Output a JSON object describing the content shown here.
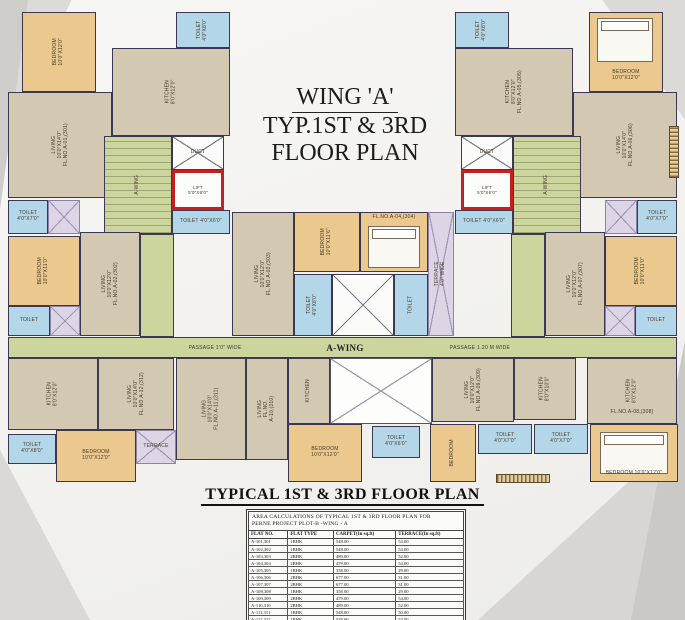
{
  "title": {
    "line1": "WING 'A'",
    "line2": "TYP.1ST & 3RD",
    "line3": "FLOOR PLAN"
  },
  "footer": {
    "heading": "TYPICAL 1ST & 3RD FLOOR PLAN"
  },
  "plan": {
    "passage_left": "PASSAGE 1'0\" WIDE",
    "wing_label": "A-WING",
    "passage_right": "PASSAGE 1.20 M WIDE",
    "colors": {
      "bedroom": "#ebc98e",
      "living_kitchen": "#d3c9b3",
      "toilet": "#b3d7e8",
      "terrace": "#ddd5e6",
      "stair_passage": "#ccd59d",
      "lift_outline": "#c4201e",
      "wall": "#3d3852"
    },
    "rooms": [
      {
        "t": "bed",
        "x": 22,
        "y": 12,
        "w": 74,
        "h": 80,
        "l": "BEDROOM\n10'0\"X12'0\"",
        "rot": true
      },
      {
        "t": "toi",
        "x": 176,
        "y": 12,
        "w": 54,
        "h": 36,
        "l": "TOILET\n4'0\"X8'0\"",
        "rot": true
      },
      {
        "t": "kit",
        "x": 112,
        "y": 48,
        "w": 118,
        "h": 88,
        "l": "KITCHEN\n8'0\"X12'0\"",
        "rot": true
      },
      {
        "t": "liv",
        "x": 8,
        "y": 92,
        "w": 104,
        "h": 106,
        "l": "LIVING\n10'0\"X14'0\"\nFL.NO.A-01,(301)",
        "rot": true
      },
      {
        "t": "stair",
        "x": 104,
        "y": 136,
        "w": 68,
        "h": 98,
        "l": "A-WING",
        "rot": true
      },
      {
        "t": "duct",
        "x": 172,
        "y": 136,
        "w": 52,
        "h": 34,
        "l": "DUCT",
        "rot": false
      },
      {
        "t": "lift",
        "x": 172,
        "y": 170,
        "w": 52,
        "h": 40,
        "l": "LIFT\n5'0\"X6'0\"",
        "rot": false
      },
      {
        "t": "toi",
        "x": 172,
        "y": 210,
        "w": 58,
        "h": 24,
        "l": "TOILET 4'0\"X6'0\"",
        "rot": false
      },
      {
        "t": "toi",
        "x": 8,
        "y": 200,
        "w": 40,
        "h": 34,
        "l": "TOILET\n4'0\"X7'0\"",
        "rot": false
      },
      {
        "t": "ter",
        "x": 48,
        "y": 200,
        "w": 32,
        "h": 34,
        "l": "",
        "rot": false
      },
      {
        "t": "bed",
        "x": 8,
        "y": 236,
        "w": 72,
        "h": 70,
        "l": "BEDROOM\n10'0\"X11'0\"",
        "rot": true
      },
      {
        "t": "liv",
        "x": 80,
        "y": 232,
        "w": 60,
        "h": 104,
        "l": "LIVING\n10'0\"X12'0\"\nFL.NO.A-02,(302)",
        "rot": true
      },
      {
        "t": "passv",
        "x": 140,
        "y": 234,
        "w": 34,
        "h": 103,
        "l": "",
        "rot": false
      },
      {
        "t": "toi",
        "x": 8,
        "y": 306,
        "w": 42,
        "h": 30,
        "l": "TOILET",
        "rot": false
      },
      {
        "t": "ter",
        "x": 50,
        "y": 306,
        "w": 30,
        "h": 30,
        "l": "",
        "rot": false
      },
      {
        "t": "pass",
        "x": 8,
        "y": 337,
        "w": 669,
        "h": 21,
        "l": "",
        "rot": false
      },
      {
        "t": "kit",
        "x": 8,
        "y": 358,
        "w": 90,
        "h": 72,
        "l": "KITCHEN\n8'0\"X12'0\"",
        "rot": true
      },
      {
        "t": "liv",
        "x": 98,
        "y": 358,
        "w": 76,
        "h": 72,
        "l": "LIVING\n10'0\"X14'0\"\nFL.NO.A-12,(312)",
        "rot": true
      },
      {
        "t": "bed",
        "x": 56,
        "y": 430,
        "w": 80,
        "h": 52,
        "l": "BEDROOM\n10'0\"X12'0\"",
        "rot": false
      },
      {
        "t": "toi",
        "x": 8,
        "y": 434,
        "w": 48,
        "h": 30,
        "l": "TOILET\n4'0\"X8'0\"",
        "rot": false
      },
      {
        "t": "ter",
        "x": 136,
        "y": 430,
        "w": 40,
        "h": 34,
        "l": "TERRACE",
        "rot": false
      },
      {
        "t": "liv",
        "x": 232,
        "y": 212,
        "w": 62,
        "h": 124,
        "l": "LIVING\n10'0\"X12'0\"\nFL.NO.A-03,(303)",
        "rot": true
      },
      {
        "t": "bed",
        "x": 294,
        "y": 212,
        "w": 66,
        "h": 60,
        "l": "BEDROOM\n10'0\"X11'6\"",
        "rot": true
      },
      {
        "t": "bed",
        "x": 360,
        "y": 212,
        "w": 68,
        "h": 60,
        "l": "",
        "rot": false
      },
      {
        "t": "lbl",
        "x": 362,
        "y": 212,
        "w": 64,
        "h": 12,
        "l": "FL.NO.A-04,(304)",
        "rot": false
      },
      {
        "t": "furn",
        "x": 368,
        "y": 226,
        "w": 52,
        "h": 42,
        "l": "",
        "rot": false
      },
      {
        "t": "toi",
        "x": 294,
        "y": 274,
        "w": 38,
        "h": 62,
        "l": "TOILET\n4'0\"X8'0\"",
        "rot": true
      },
      {
        "t": "duct",
        "x": 332,
        "y": 274,
        "w": 62,
        "h": 62,
        "l": "",
        "rot": false
      },
      {
        "t": "toi",
        "x": 394,
        "y": 274,
        "w": 34,
        "h": 62,
        "l": "TOILET",
        "rot": true
      },
      {
        "t": "ter",
        "x": 428,
        "y": 212,
        "w": 26,
        "h": 124,
        "l": "TERRACE\n4'0\" WIDE",
        "rot": true
      },
      {
        "t": "liv",
        "x": 176,
        "y": 358,
        "w": 70,
        "h": 102,
        "l": "LIVING\n10'0\"X14'0\"\nFL.NO.A-11,(311)",
        "rot": true
      },
      {
        "t": "liv",
        "x": 246,
        "y": 358,
        "w": 42,
        "h": 102,
        "l": "LIVING\nFL.NO.\nA-10,(310)",
        "rot": true
      },
      {
        "t": "kit",
        "x": 288,
        "y": 358,
        "w": 42,
        "h": 66,
        "l": "KITCHEN",
        "rot": true
      },
      {
        "t": "open",
        "x": 330,
        "y": 358,
        "w": 102,
        "h": 66,
        "l": "",
        "rot": false
      },
      {
        "t": "bed",
        "x": 288,
        "y": 424,
        "w": 74,
        "h": 58,
        "l": "BEDROOM\n10'0\"X12'0\"",
        "rot": false
      },
      {
        "t": "toi",
        "x": 372,
        "y": 426,
        "w": 48,
        "h": 32,
        "l": "TOILET\n4'0\"X6'0\"",
        "rot": false
      },
      {
        "t": "bed",
        "x": 589,
        "y": 12,
        "w": 74,
        "h": 80,
        "l": "",
        "rot": false
      },
      {
        "t": "furn",
        "x": 597,
        "y": 18,
        "w": 56,
        "h": 44,
        "l": "",
        "rot": false
      },
      {
        "t": "lbl",
        "x": 591,
        "y": 66,
        "w": 70,
        "h": 20,
        "l": "BEDROOM\n10'0\"X12'0\"",
        "rot": false
      },
      {
        "t": "toi",
        "x": 455,
        "y": 12,
        "w": 54,
        "h": 36,
        "l": "TOILET\n4'0\"X8'0\"",
        "rot": true
      },
      {
        "t": "kit",
        "x": 455,
        "y": 48,
        "w": 118,
        "h": 88,
        "l": "KITCHEN\n8'0\"X12'0\"\nFL.NO.A-05,(305)",
        "rot": true
      },
      {
        "t": "liv",
        "x": 573,
        "y": 92,
        "w": 104,
        "h": 106,
        "l": "LIVING\n10'0\"X14'0\"\nFL.NO.A-06,(306)",
        "rot": true
      },
      {
        "t": "stair",
        "x": 513,
        "y": 136,
        "w": 68,
        "h": 98,
        "l": "A-WING",
        "rot": true
      },
      {
        "t": "duct",
        "x": 461,
        "y": 136,
        "w": 52,
        "h": 34,
        "l": "DUCT",
        "rot": false
      },
      {
        "t": "lift",
        "x": 461,
        "y": 170,
        "w": 52,
        "h": 40,
        "l": "LIFT\n5'0\"X6'0\"",
        "rot": false
      },
      {
        "t": "toi",
        "x": 455,
        "y": 210,
        "w": 58,
        "h": 24,
        "l": "TOILET 4'0\"X6'0\"",
        "rot": false
      },
      {
        "t": "toi",
        "x": 637,
        "y": 200,
        "w": 40,
        "h": 34,
        "l": "TOILET\n4'0\"X7'0\"",
        "rot": false
      },
      {
        "t": "ter",
        "x": 605,
        "y": 200,
        "w": 32,
        "h": 34,
        "l": "",
        "rot": false
      },
      {
        "t": "bed",
        "x": 605,
        "y": 236,
        "w": 72,
        "h": 70,
        "l": "BEDROOM\n10'0\"X11'0\"",
        "rot": true
      },
      {
        "t": "liv",
        "x": 545,
        "y": 232,
        "w": 60,
        "h": 104,
        "l": "LIVING\n10'0\"X12'0\"\nFL.NO.A-07,(307)",
        "rot": true
      },
      {
        "t": "passv",
        "x": 511,
        "y": 234,
        "w": 34,
        "h": 103,
        "l": "",
        "rot": false
      },
      {
        "t": "ter",
        "x": 605,
        "y": 306,
        "w": 30,
        "h": 30,
        "l": "",
        "rot": false
      },
      {
        "t": "toi",
        "x": 635,
        "y": 306,
        "w": 42,
        "h": 30,
        "l": "TOILET",
        "rot": false
      },
      {
        "t": "liv",
        "x": 432,
        "y": 358,
        "w": 82,
        "h": 64,
        "l": "LIVING\n10'0\"X12'0\"\nFL.NO.A-09,(309)",
        "rot": true
      },
      {
        "t": "kit",
        "x": 514,
        "y": 358,
        "w": 62,
        "h": 62,
        "l": "KITCHEN\n8'0\"X10'0\"",
        "rot": true
      },
      {
        "t": "kit",
        "x": 587,
        "y": 358,
        "w": 90,
        "h": 66,
        "l": "KITCHEN\n8'0\"X12'0\"",
        "rot": true
      },
      {
        "t": "lbl",
        "x": 592,
        "y": 406,
        "w": 80,
        "h": 14,
        "l": "FL.NO.A-08,(308)",
        "rot": false
      },
      {
        "t": "toi",
        "x": 478,
        "y": 424,
        "w": 54,
        "h": 30,
        "l": "TOILET\n4'0\"X7'0\"",
        "rot": false
      },
      {
        "t": "toi",
        "x": 534,
        "y": 424,
        "w": 54,
        "h": 30,
        "l": "TOILET\n4'0\"X7'0\"",
        "rot": false
      },
      {
        "t": "bed",
        "x": 590,
        "y": 424,
        "w": 88,
        "h": 58,
        "l": "",
        "rot": false
      },
      {
        "t": "furn",
        "x": 600,
        "y": 432,
        "w": 68,
        "h": 42,
        "l": "",
        "rot": false
      },
      {
        "t": "lbl",
        "x": 594,
        "y": 468,
        "w": 80,
        "h": 12,
        "l": "BEDROOM 10'0\"X12'0\"",
        "rot": false
      },
      {
        "t": "bed",
        "x": 430,
        "y": 424,
        "w": 46,
        "h": 58,
        "l": "BEDROOM",
        "rot": true
      },
      {
        "t": "steps",
        "x": 669,
        "y": 126,
        "w": 10,
        "h": 52,
        "l": "",
        "rot": false
      },
      {
        "t": "stepsh",
        "x": 496,
        "y": 474,
        "w": 54,
        "h": 9,
        "l": "",
        "rot": false
      }
    ]
  },
  "table": {
    "caption_line1": "AREA CALCULATIONS OF TYPICAL  1ST & 3RD FLOOR PLAN FOR",
    "caption_line2": "PERNE PROJECT PLOT-B -WING - A",
    "columns": [
      "FLAT NO.",
      "FLAT TYPE",
      "CARPET(In sq.ft)",
      "TERRACE(In sq.ft)"
    ],
    "rows": [
      [
        "A-101,301",
        "1BHK",
        "548.00",
        "54.00"
      ],
      [
        "A-102,302",
        "1BHK",
        "548.00",
        "54.00"
      ],
      [
        "A-103,303",
        "2BHK",
        "489.00",
        "52.00"
      ],
      [
        "A-104,304",
        "2BHK",
        "479.00",
        "54.00"
      ],
      [
        "A-105,305",
        "1BHK",
        "358.00",
        "29.00"
      ],
      [
        "A-106,306",
        "2BHK",
        "677.00",
        "31.00"
      ],
      [
        "A-107,307",
        "2BHK",
        "677.00",
        "31.00"
      ],
      [
        "A-108,308",
        "1BHK",
        "358.00",
        "29.00"
      ],
      [
        "A-109,309",
        "2BHK",
        "479.00",
        "54.00"
      ],
      [
        "A-110,310",
        "2BHK",
        "489.00",
        "52.00"
      ],
      [
        "A-111,311",
        "1BHK",
        "548.00",
        "50.00"
      ],
      [
        "A-112,312",
        "1BHK",
        "548.00",
        "54.00"
      ]
    ]
  }
}
